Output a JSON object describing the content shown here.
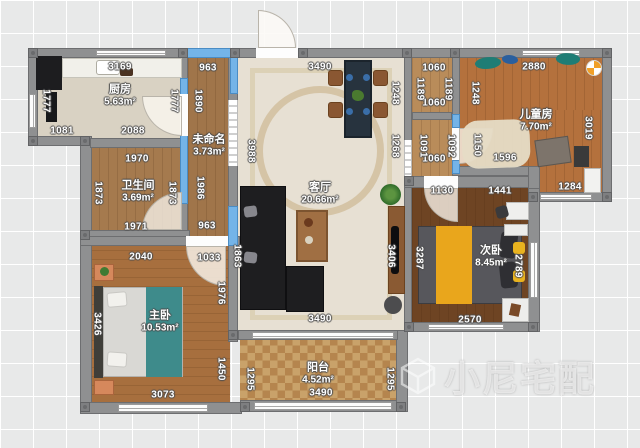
{
  "app": {
    "watermark_text": "小尼宅配",
    "watermark_icon": "cube-logo-icon"
  },
  "colors": {
    "selected_wall": "#74b4e8",
    "wall": "#8f9091",
    "background": "#e8e9e9",
    "living_floor": "#e7e0d3",
    "wood_floor": "#a0754a",
    "accent_blanket_teal": "#3e8b8b",
    "accent_blanket_yellow": "#e9a61c",
    "sofa_black": "#1e1e20"
  },
  "rooms": [
    {
      "id": "kitchen",
      "name": "厨房",
      "area": "5.63m²"
    },
    {
      "id": "corridor",
      "name": "未命名",
      "area": "3.73m²"
    },
    {
      "id": "bathroom",
      "name": "卫生间",
      "area": "3.69m²"
    },
    {
      "id": "living",
      "name": "客厅",
      "area": "20.66m²"
    },
    {
      "id": "children",
      "name": "儿童房",
      "area": "7.70m²"
    },
    {
      "id": "second",
      "name": "次卧",
      "area": "8.45m²"
    },
    {
      "id": "master",
      "name": "主卧",
      "area": "10.53m²"
    },
    {
      "id": "balcony",
      "name": "阳台",
      "area": "4.52m²"
    }
  ],
  "dimensions": [
    {
      "text": "3169",
      "x": 120,
      "y": 67,
      "rot": 0
    },
    {
      "text": "963",
      "x": 208,
      "y": 68,
      "rot": 0
    },
    {
      "text": "3490",
      "x": 320,
      "y": 67,
      "rot": 0
    },
    {
      "text": "1060",
      "x": 434,
      "y": 68,
      "rot": 0
    },
    {
      "text": "2880",
      "x": 534,
      "y": 67,
      "rot": 0
    },
    {
      "text": "1081",
      "x": 62,
      "y": 131,
      "rot": 0
    },
    {
      "text": "2088",
      "x": 133,
      "y": 131,
      "rot": 0
    },
    {
      "text": "1060",
      "x": 434,
      "y": 103,
      "rot": 0
    },
    {
      "text": "1060",
      "x": 434,
      "y": 159,
      "rot": 0
    },
    {
      "text": "1596",
      "x": 505,
      "y": 158,
      "rot": 0
    },
    {
      "text": "1970",
      "x": 137,
      "y": 159,
      "rot": 0
    },
    {
      "text": "1971",
      "x": 136,
      "y": 227,
      "rot": 0
    },
    {
      "text": "963",
      "x": 207,
      "y": 226,
      "rot": 0
    },
    {
      "text": "1284",
      "x": 570,
      "y": 187,
      "rot": 0
    },
    {
      "text": "1130",
      "x": 442,
      "y": 191,
      "rot": 0
    },
    {
      "text": "1441",
      "x": 500,
      "y": 191,
      "rot": 0
    },
    {
      "text": "2040",
      "x": 141,
      "y": 257,
      "rot": 0
    },
    {
      "text": "1033",
      "x": 209,
      "y": 258,
      "rot": 0
    },
    {
      "text": "3490",
      "x": 320,
      "y": 319,
      "rot": 0
    },
    {
      "text": "2570",
      "x": 470,
      "y": 320,
      "rot": 0
    },
    {
      "text": "3073",
      "x": 163,
      "y": 395,
      "rot": 0
    },
    {
      "text": "3490",
      "x": 321,
      "y": 393,
      "rot": 0
    },
    {
      "text": "1777",
      "x": 46,
      "y": 101,
      "rot": 1
    },
    {
      "text": "1777",
      "x": 174,
      "y": 101,
      "rot": 1
    },
    {
      "text": "1890",
      "x": 198,
      "y": 101,
      "rot": 1
    },
    {
      "text": "1986",
      "x": 200,
      "y": 188,
      "rot": 1
    },
    {
      "text": "3988",
      "x": 251,
      "y": 151,
      "rot": 1
    },
    {
      "text": "1248",
      "x": 395,
      "y": 93,
      "rot": 1
    },
    {
      "text": "1268",
      "x": 395,
      "y": 146,
      "rot": 1
    },
    {
      "text": "1189",
      "x": 420,
      "y": 89,
      "rot": 1
    },
    {
      "text": "1189",
      "x": 448,
      "y": 89,
      "rot": 1
    },
    {
      "text": "1091",
      "x": 423,
      "y": 146,
      "rot": 1
    },
    {
      "text": "1092",
      "x": 451,
      "y": 146,
      "rot": 1
    },
    {
      "text": "1248",
      "x": 475,
      "y": 93,
      "rot": 1
    },
    {
      "text": "1150",
      "x": 477,
      "y": 145,
      "rot": 1
    },
    {
      "text": "3019",
      "x": 588,
      "y": 128,
      "rot": 1
    },
    {
      "text": "1873",
      "x": 98,
      "y": 193,
      "rot": 1
    },
    {
      "text": "1873",
      "x": 172,
      "y": 193,
      "rot": 1
    },
    {
      "text": "3426",
      "x": 97,
      "y": 324,
      "rot": 1
    },
    {
      "text": "1976",
      "x": 221,
      "y": 293,
      "rot": 1
    },
    {
      "text": "1450",
      "x": 221,
      "y": 369,
      "rot": 1
    },
    {
      "text": "1863",
      "x": 237,
      "y": 256,
      "rot": 1
    },
    {
      "text": "3406",
      "x": 391,
      "y": 256,
      "rot": 1
    },
    {
      "text": "3287",
      "x": 419,
      "y": 258,
      "rot": 1
    },
    {
      "text": "2789",
      "x": 518,
      "y": 266,
      "rot": 1
    },
    {
      "text": "1295",
      "x": 250,
      "y": 379,
      "rot": 1
    },
    {
      "text": "1295",
      "x": 390,
      "y": 379,
      "rot": 1
    }
  ]
}
